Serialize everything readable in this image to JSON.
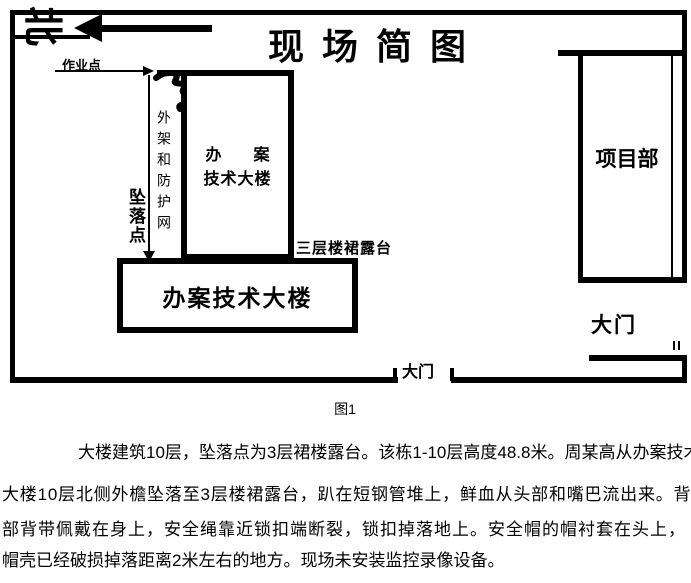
{
  "colors": {
    "ink": "#000000",
    "paper": "#ffffff"
  },
  "diagram": {
    "title": "现场简图",
    "north_label": "北",
    "work_point_label": "作业点",
    "scaffold_net_label": "外架和防护网",
    "fall_point_label": "坠落点",
    "tall_building_label_line1": "办　案",
    "tall_building_label_line2": "技术大楼",
    "terrace_label": "三层楼裙露台",
    "podium_building_label": "办案技术大楼",
    "project_dept_label": "项目部",
    "side_gate_label": "大门",
    "main_gate_label": "大门"
  },
  "caption": "图1",
  "description": {
    "lines": [
      "大楼建筑10层，坠落点为3层裙楼露台。该栋1-10层高度48.8米。周某高从办案技术",
      "大楼10层北侧外檐坠落至3层楼裙露台，趴在短钢管堆上，鲜血从头部和嘴巴流出来。背",
      "部背带佩戴在身上，安全绳靠近锁扣端断裂，锁扣掉落地上。安全帽的帽衬套在头上，",
      "帽壳已经破损掉落距离2米左右的地方。现场未安装监控录像设备。"
    ]
  }
}
